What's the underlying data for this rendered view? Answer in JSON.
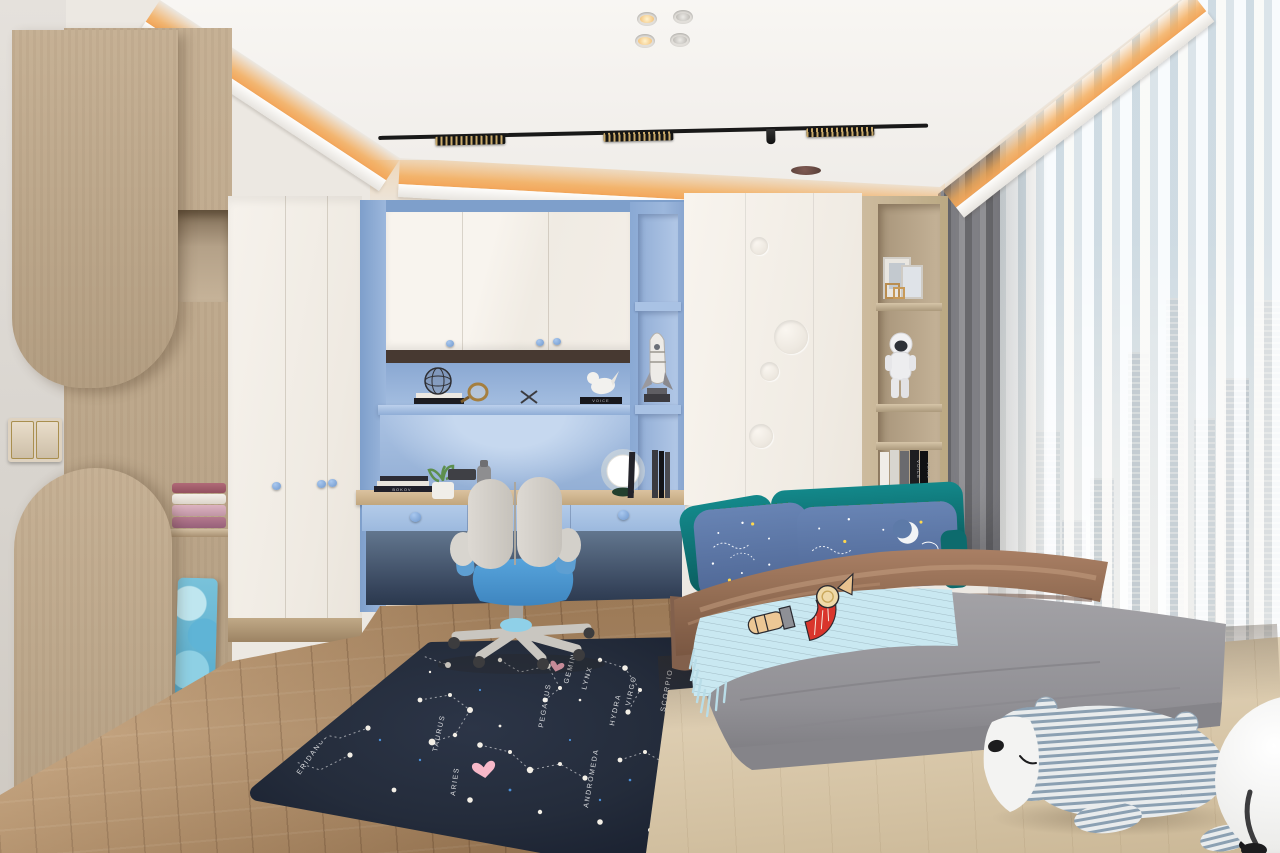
{
  "scene": {
    "type": "interior-render",
    "room": "children's bedroom with study nook, platform bed and city-view window",
    "style": "modern white + light oak + powder blue"
  },
  "palette": {
    "wall": "#ece8e2",
    "ceiling": "#f5f3f0",
    "cove": "#f3a65a",
    "wood": "#c2ad91",
    "woodDeep": "#a78e71",
    "floor": "#b7946f",
    "platform": "#dccbae",
    "whiteCab": "#f4f0e9",
    "alcove": "#9cb7dc",
    "alcoveDeep": "#7e9fcb",
    "drawer": "#a9c4e6",
    "knobBlue": "#84abdd",
    "brownStrip": "#473931",
    "deskWood": "#cdb391",
    "teal": "#0e7678",
    "pillowBlue": "#5d7aa8",
    "navyPillow": "#2a3350",
    "blanketBrown": "#97715a",
    "duvetGray": "#96959a",
    "throwBlue": "#c8e7f0",
    "rugNavy": "#242c3b",
    "curtainGray": "#86868b",
    "sheer": "#f4f2ef",
    "sky": "#bdd8ec",
    "seatBlue": "#4b9bd6"
  },
  "rug": {
    "theme": "constellation star map with pink hearts",
    "labels": [
      "LEO",
      "FORNAX",
      "ERIDANUS",
      "TAURUS",
      "ARIES",
      "GEMINI",
      "PEGASUS",
      "LYNX",
      "VIRGO",
      "HYDRA",
      "SCORPIO",
      "ANDROMEDA",
      "AQUARIUS"
    ]
  },
  "books": {
    "headboard_spine": "VOICE",
    "shelf_spine": "VOICE",
    "desk_spine": "BOKOV"
  },
  "lighting": {
    "cove": "warm LED cove around ceiling tray",
    "downlights": "4",
    "track_modules": "3"
  }
}
